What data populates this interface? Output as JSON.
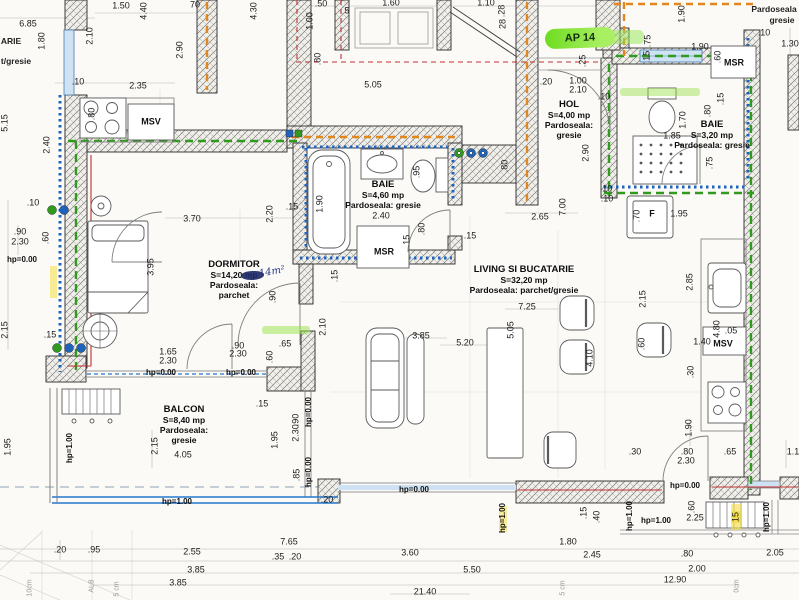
{
  "apartment": {
    "badge": "AP 14"
  },
  "rooms": {
    "hol": {
      "name": "HOL",
      "area": "S=4,00 mp",
      "floor1": "Pardoseala:",
      "floor2": "gresie"
    },
    "baie1": {
      "name": "BAIE",
      "area": "S=4,60 mp",
      "floor1": "Pardoseala: gresie"
    },
    "baie2": {
      "name": "BAIE",
      "area": "S=3,20 mp",
      "floor1": "Pardoseala: gresie"
    },
    "dormitor": {
      "name": "DORMITOR",
      "area": "S=14,20 mp",
      "floor1": "Pardoseala:",
      "floor2": "parchet",
      "handnote": "14m²"
    },
    "living": {
      "name": "LIVING SI BUCATARIE",
      "area": "S=32,20 mp",
      "floor1": "Pardoseala: parchet/gresie"
    },
    "balcon": {
      "name": "BALCON",
      "area": "S=8,40 mp",
      "floor1": "Pardoseala:",
      "floor2": "gresie"
    }
  },
  "colors": {
    "highlight_green": "#7ce32a",
    "pipe_orange": "#e2861f",
    "pipe_green": "#2f9a1e",
    "insulation_blue": "#1f63bb",
    "heating_red": "#c03030",
    "window_blue": "#2277cc"
  },
  "appliances": [
    {
      "t": "MSR",
      "x": 384,
      "y": 252
    },
    {
      "t": "MSR",
      "x": 734,
      "y": 63
    },
    {
      "t": "MSV",
      "x": 151,
      "y": 122
    },
    {
      "t": "MSV",
      "x": 723,
      "y": 344
    },
    {
      "t": "F",
      "x": 652,
      "y": 214
    }
  ],
  "levels": [
    {
      "t": "hp=0.00",
      "x": 22,
      "y": 260
    },
    {
      "t": "hp=0.00",
      "x": 161,
      "y": 373
    },
    {
      "t": "hp=0.00",
      "x": 241,
      "y": 373
    },
    {
      "t": "hp=0.00",
      "x": 414,
      "y": 490
    },
    {
      "t": "hp=0.00",
      "x": 685,
      "y": 486
    },
    {
      "t": "hp=0.00",
      "x": 309,
      "y": 412,
      "v": 1
    },
    {
      "t": "hp=0.00",
      "x": 309,
      "y": 472,
      "v": 1
    },
    {
      "t": "hp=1.00",
      "x": 177,
      "y": 502
    },
    {
      "t": "hp=1.00",
      "x": 656,
      "y": 521
    },
    {
      "t": "hp=1.00",
      "x": 70,
      "y": 448,
      "v": 1
    },
    {
      "t": "hp=1.00",
      "x": 503,
      "y": 518,
      "v": 1
    },
    {
      "t": "hp=1.00",
      "x": 630,
      "y": 516,
      "v": 1
    },
    {
      "t": "hp=1.00",
      "x": 767,
      "y": 517,
      "v": 1
    }
  ],
  "fragments": [
    {
      "t": "ARIE",
      "x": 11,
      "y": 41
    },
    {
      "t": "t/gresie",
      "x": 16,
      "y": 61
    },
    {
      "t": "Pardoseala",
      "x": 774,
      "y": 9
    },
    {
      "t": "gresie",
      "x": 782,
      "y": 20
    },
    {
      "t": "10cm",
      "x": 30,
      "y": 588,
      "v": 1,
      "f": 1
    },
    {
      "t": "ALB",
      "x": 92,
      "y": 586,
      "v": 1,
      "f": 1
    },
    {
      "t": "5 cm",
      "x": 117,
      "y": 589,
      "v": 1,
      "f": 1
    },
    {
      "t": "5 cm",
      "x": 563,
      "y": 588,
      "v": 1,
      "f": 1
    },
    {
      "t": "0cm",
      "x": 737,
      "y": 586,
      "v": 1,
      "f": 1
    }
  ],
  "dims": [
    {
      "t": "6.85",
      "x": 28,
      "y": 24
    },
    {
      "t": "1.80",
      "x": 42,
      "y": 41,
      "v": 1
    },
    {
      "t": "2.10",
      "x": 90,
      "y": 36,
      "v": 1
    },
    {
      "t": "1.50",
      "x": 121,
      "y": 6
    },
    {
      "t": "4.40",
      "x": 144,
      "y": 11,
      "v": 1
    },
    {
      "t": "70",
      "x": 195,
      "y": 5
    },
    {
      "t": "2.90",
      "x": 180,
      "y": 50,
      "v": 1
    },
    {
      "t": ".10",
      "x": 78,
      "y": 82
    },
    {
      "t": "2.35",
      "x": 138,
      "y": 86
    },
    {
      "t": ".80",
      "x": 92,
      "y": 114,
      "v": 1
    },
    {
      "t": "5.15",
      "x": 5,
      "y": 123,
      "v": 1
    },
    {
      "t": "2.40",
      "x": 47,
      "y": 145,
      "v": 1
    },
    {
      "t": "4.30",
      "x": 254,
      "y": 11,
      "v": 1
    },
    {
      "t": ".50",
      "x": 321,
      "y": 4
    },
    {
      "t": "1.00",
      "x": 310,
      "y": 21,
      "v": 1
    },
    {
      "t": ".80",
      "x": 318,
      "y": 59,
      "v": 1
    },
    {
      "t": "1.60",
      "x": 391,
      "y": 3
    },
    {
      "t": "5",
      "x": 347,
      "y": 11
    },
    {
      "t": "5.05",
      "x": 373,
      "y": 85
    },
    {
      "t": "1.10",
      "x": 486,
      "y": 3
    },
    {
      "t": ".28",
      "x": 502,
      "y": 11,
      "v": 1
    },
    {
      "t": "28",
      "x": 503,
      "y": 24,
      "v": 1
    },
    {
      "t": ".20",
      "x": 546,
      "y": 82
    },
    {
      "t": "1.00",
      "x": 578,
      "y": 81
    },
    {
      "t": "2.10",
      "x": 578,
      "y": 90
    },
    {
      "t": ".25",
      "x": 583,
      "y": 61,
      "v": 1
    },
    {
      "t": ".10",
      "x": 604,
      "y": 97
    },
    {
      "t": "2.90",
      "x": 586,
      "y": 153,
      "v": 1
    },
    {
      "t": ".10",
      "x": 606,
      "y": 189
    },
    {
      "t": "1.90",
      "x": 682,
      "y": 14,
      "v": 1
    },
    {
      "t": ".75",
      "x": 648,
      "y": 41,
      "v": 1
    },
    {
      "t": ".15",
      "x": 647,
      "y": 57,
      "v": 1
    },
    {
      "t": "1.90",
      "x": 700,
      "y": 47
    },
    {
      "t": ".60",
      "x": 718,
      "y": 57,
      "v": 1
    },
    {
      "t": ".10",
      "x": 764,
      "y": 33
    },
    {
      "t": "1.30",
      "x": 790,
      "y": 44
    },
    {
      "t": "1.70",
      "x": 683,
      "y": 120,
      "v": 1
    },
    {
      "t": ".80",
      "x": 708,
      "y": 111,
      "v": 1
    },
    {
      "t": ".15",
      "x": 721,
      "y": 99,
      "v": 1
    },
    {
      "t": "1.85",
      "x": 672,
      "y": 136
    },
    {
      "t": ".75",
      "x": 710,
      "y": 163,
      "v": 1
    },
    {
      "t": "3.70",
      "x": 192,
      "y": 219
    },
    {
      "t": "2.20",
      "x": 270,
      "y": 214,
      "v": 1
    },
    {
      "t": ".15",
      "x": 292,
      "y": 207
    },
    {
      "t": "1.90",
      "x": 320,
      "y": 204,
      "v": 1
    },
    {
      "t": ".95",
      "x": 417,
      "y": 172,
      "v": 1
    },
    {
      "t": "2.40",
      "x": 381,
      "y": 216
    },
    {
      "t": ".80",
      "x": 422,
      "y": 229,
      "v": 1
    },
    {
      "t": ".15",
      "x": 407,
      "y": 241,
      "v": 1
    },
    {
      "t": ".15",
      "x": 335,
      "y": 276,
      "v": 1
    },
    {
      "t": "2.65",
      "x": 540,
      "y": 217
    },
    {
      "t": "7.00",
      "x": 563,
      "y": 207,
      "v": 1
    },
    {
      "t": ".80",
      "x": 505,
      "y": 166,
      "v": 1
    },
    {
      "t": ".15",
      "x": 470,
      "y": 236
    },
    {
      "t": "3.95",
      "x": 151,
      "y": 267,
      "v": 1
    },
    {
      "t": ".90",
      "x": 273,
      "y": 297,
      "v": 1
    },
    {
      "t": "2.10",
      "x": 323,
      "y": 327,
      "v": 1
    },
    {
      "t": "1.65",
      "x": 168,
      "y": 352
    },
    {
      "t": "2.30",
      "x": 168,
      "y": 361
    },
    {
      "t": ".90",
      "x": 238,
      "y": 346
    },
    {
      "t": "2.30",
      "x": 238,
      "y": 354
    },
    {
      "t": ".65",
      "x": 285,
      "y": 344
    },
    {
      "t": ".60",
      "x": 270,
      "y": 357,
      "v": 1
    },
    {
      "t": ".15",
      "x": 262,
      "y": 404
    },
    {
      "t": ".10",
      "x": 33,
      "y": 203
    },
    {
      "t": ".90",
      "x": 20,
      "y": 232
    },
    {
      "t": "2.30",
      "x": 20,
      "y": 242
    },
    {
      "t": ".60",
      "x": 46,
      "y": 238,
      "v": 1
    },
    {
      "t": ".15",
      "x": 50,
      "y": 335
    },
    {
      "t": "2.15",
      "x": 5,
      "y": 330,
      "v": 1
    },
    {
      "t": "1.95",
      "x": 8,
      "y": 447,
      "v": 1
    },
    {
      "t": "2.15",
      "x": 155,
      "y": 446,
      "v": 1
    },
    {
      "t": "4.05",
      "x": 183,
      "y": 455
    },
    {
      "t": "1.95",
      "x": 275,
      "y": 440,
      "v": 1
    },
    {
      "t": ".90",
      "x": 296,
      "y": 420,
      "v": 1
    },
    {
      "t": "2.30",
      "x": 296,
      "y": 433,
      "v": 1
    },
    {
      "t": ".85",
      "x": 297,
      "y": 475,
      "v": 1
    },
    {
      "t": ".20",
      "x": 327,
      "y": 500
    },
    {
      "t": ".10",
      "x": 607,
      "y": 199
    },
    {
      "t": ".70",
      "x": 637,
      "y": 216,
      "v": 1
    },
    {
      "t": "1.95",
      "x": 679,
      "y": 214
    },
    {
      "t": "2.85",
      "x": 690,
      "y": 282,
      "v": 1
    },
    {
      "t": "2.15",
      "x": 643,
      "y": 299,
      "v": 1
    },
    {
      "t": "7.25",
      "x": 527,
      "y": 307
    },
    {
      "t": "3.85",
      "x": 421,
      "y": 336
    },
    {
      "t": "5.20",
      "x": 465,
      "y": 343
    },
    {
      "t": "5.05",
      "x": 511,
      "y": 330,
      "v": 1
    },
    {
      "t": "4.10",
      "x": 590,
      "y": 358,
      "v": 1
    },
    {
      "t": ".60",
      "x": 642,
      "y": 344,
      "v": 1
    },
    {
      "t": "4.80",
      "x": 717,
      "y": 329,
      "v": 1
    },
    {
      "t": ".05",
      "x": 731,
      "y": 331
    },
    {
      "t": "1.40",
      "x": 702,
      "y": 342
    },
    {
      "t": ".30",
      "x": 691,
      "y": 372,
      "v": 1
    },
    {
      "t": "1.90",
      "x": 689,
      "y": 428,
      "v": 1
    },
    {
      "t": ".30",
      "x": 635,
      "y": 452
    },
    {
      "t": ".80",
      "x": 687,
      "y": 452
    },
    {
      "t": "2.30",
      "x": 686,
      "y": 461
    },
    {
      "t": ".65",
      "x": 730,
      "y": 452
    },
    {
      "t": "1.1",
      "x": 793,
      "y": 452
    },
    {
      "t": ".60",
      "x": 692,
      "y": 507,
      "v": 1
    },
    {
      "t": "2.25",
      "x": 695,
      "y": 518
    },
    {
      "t": ".15",
      "x": 584,
      "y": 513,
      "v": 1
    },
    {
      "t": ".40",
      "x": 597,
      "y": 517,
      "v": 1
    },
    {
      "t": "15",
      "x": 736,
      "y": 517,
      "v": 1,
      "hl": 1
    },
    {
      "t": "3.60",
      "x": 410,
      "y": 553
    },
    {
      "t": "1.80",
      "x": 568,
      "y": 542
    },
    {
      "t": "2.45",
      "x": 592,
      "y": 555
    },
    {
      "t": "5.50",
      "x": 472,
      "y": 570
    },
    {
      "t": "2.05",
      "x": 775,
      "y": 553
    },
    {
      "t": ".80",
      "x": 687,
      "y": 554
    },
    {
      "t": "2.00",
      "x": 697,
      "y": 569
    },
    {
      "t": "12.90",
      "x": 675,
      "y": 580
    },
    {
      "t": "21.40",
      "x": 425,
      "y": 592
    },
    {
      "t": ".20",
      "x": 60,
      "y": 550
    },
    {
      "t": ".95",
      "x": 94,
      "y": 550
    },
    {
      "t": "2.55",
      "x": 192,
      "y": 552
    },
    {
      "t": "3.85",
      "x": 196,
      "y": 570
    },
    {
      "t": "3.85",
      "x": 178,
      "y": 583
    },
    {
      "t": "7.65",
      "x": 289,
      "y": 542
    },
    {
      "t": ".35",
      "x": 278,
      "y": 557
    },
    {
      "t": ".20",
      "x": 295,
      "y": 557
    }
  ]
}
